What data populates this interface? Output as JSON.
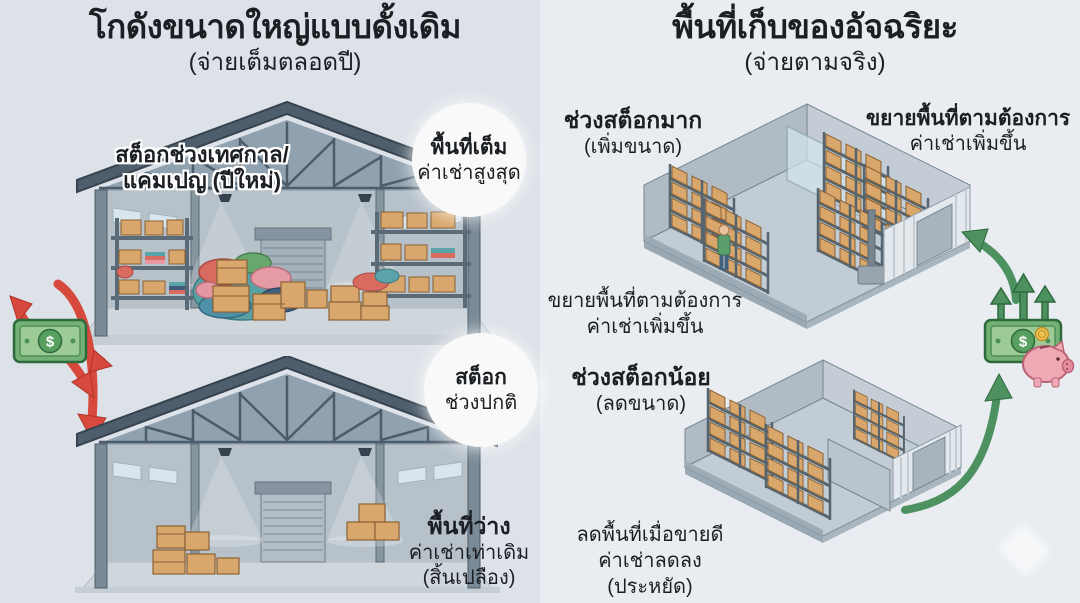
{
  "left_panel": {
    "title": "โกดังขนาดใหญ่แบบดั้งเดิม",
    "subtitle": "(จ่ายเต็มตลอดปี)",
    "seasonal_label": {
      "line1": "สต็อกช่วงเทศกาล/",
      "line2": "แคมเปญ (ปีใหม่)"
    },
    "full_badge": {
      "line1": "พื้นที่เต็ม",
      "line2": "ค่าเช่าสูงสุด"
    },
    "normal_badge": {
      "line1": "สต็อก",
      "line2": "ช่วงปกติ"
    },
    "empty_caption": {
      "line1": "พื้นที่ว่าง",
      "line2": "ค่าเช่าเท่าเดิม",
      "line3": "(สิ้นเปลือง)"
    }
  },
  "right_panel": {
    "title": "พื้นที่เก็บของอัจฉริยะ",
    "subtitle": "(จ่ายตามจริง)",
    "high_stock_label": {
      "line1": "ช่วงสต็อกมาก",
      "line2": "(เพิ่มขนาด)"
    },
    "expand_label": {
      "line1": "ขยายพื้นที่ตามต้องการ",
      "line2": "ค่าเช่าเพิ่มขึ้น"
    },
    "expand_note": {
      "line1": "ขยายพื้นที่ตามต้องการ",
      "line2": "ค่าเช่าเพิ่มขึ้น"
    },
    "low_stock_label": {
      "line1": "ช่วงสต็อกน้อย",
      "line2": "(ลดขนาด)"
    },
    "save_caption": {
      "line1": "ลดพื้นที่เมื่อขายดี",
      "line2": "ค่าเช่าลดลง",
      "line3": "(ประหยัด)"
    }
  },
  "icons": {
    "dollar_symbol": "$",
    "money_loss": "dollar-bill-with-red-outflow-arrows",
    "money_saving": "dollar-bill-with-green-up-arrows-coin-piggy-bank"
  },
  "colors": {
    "bg_left": "#dce2e8",
    "bg_right": "#e9edf2",
    "red_arrow": "#d8493d",
    "green_arrow": "#4e9160",
    "bill_green": "#74b174",
    "piggy_pink": "#efa9b4",
    "box_tan": "#d9a76c",
    "structure": "#4e5e6c",
    "text": "#1b1e22"
  }
}
